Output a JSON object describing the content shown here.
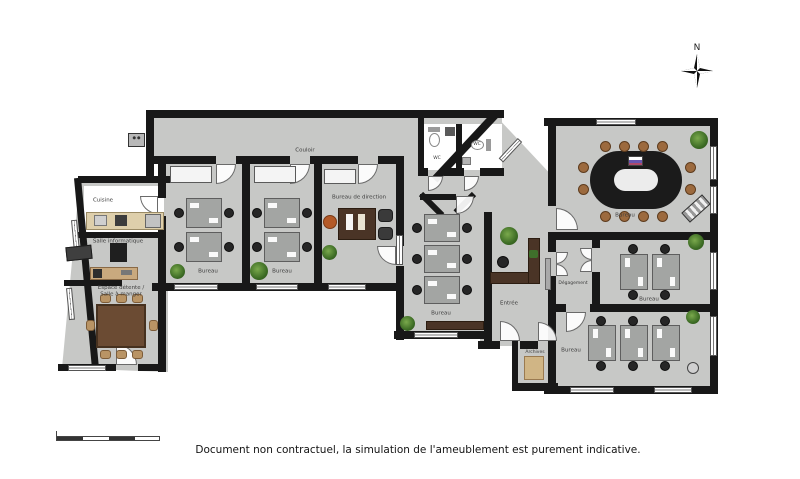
{
  "plan": {
    "compass": "N",
    "rooms": {
      "couloir": "Couloir",
      "cuisine": "Cuisine",
      "salle_informatique": "Salle informatique",
      "espace_detente": "Espace détente /",
      "salle_a_manger": "Salle à manger",
      "bureau_1": "Bureau",
      "bureau_2": "Bureau",
      "bureau_direction": "Bureau de direction",
      "wc_1": "WC",
      "wc_2": "WC",
      "bureau_open": "Bureau",
      "entree": "Entrée",
      "degagement": "Dégagement",
      "archives": "Archives",
      "bureau_reunion": "Bureau",
      "bureau_est_1": "Bureau",
      "bureau_est_2": "Bureau"
    },
    "footer_note": "Document non contractuel, la simulation de l'ameublement est purement indicative.",
    "colors": {
      "floor": "#c7c8c6",
      "wall": "#181818",
      "wood_dark": "#4a3426",
      "wood_table": "#6b4b33",
      "plant_green": "#3c6b24",
      "director_chair": "#b45a28",
      "conference_table": "#1b1b1b"
    }
  }
}
